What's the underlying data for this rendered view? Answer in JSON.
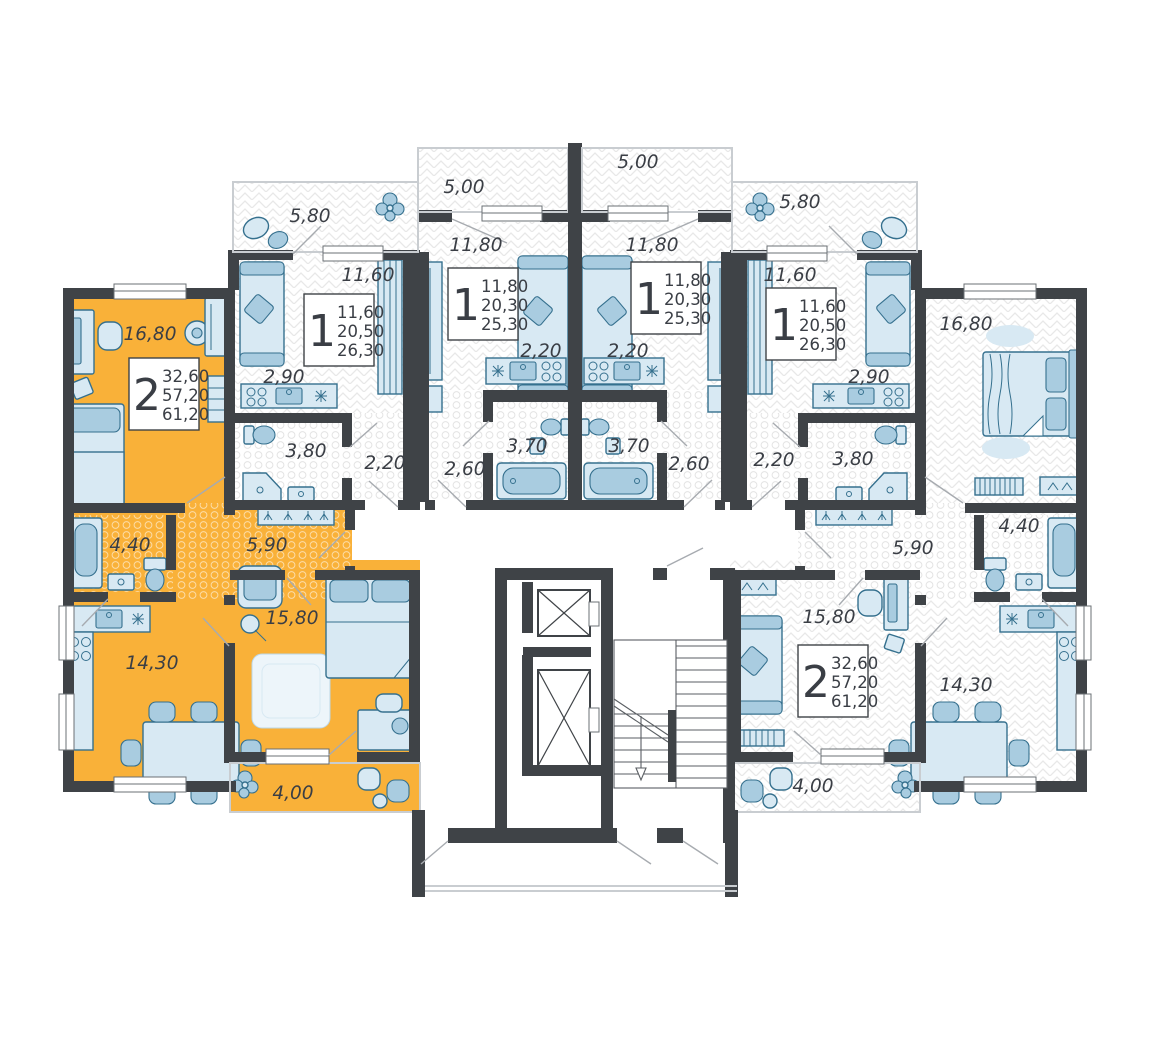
{
  "colors": {
    "wall": "#3f4347",
    "highlight_apartment": "#f9b139",
    "furniture_fill": "#d8e9f3",
    "furniture_accent": "#a9cce0",
    "furniture_stroke": "#35708e",
    "label_text": "#3a3e45"
  },
  "units": [
    {
      "name": "one-room-left",
      "rooms": "1",
      "area_living": "11,60",
      "area_main": "20,50",
      "area_total": "26,30"
    },
    {
      "name": "one-room-mid-left",
      "rooms": "1",
      "area_living": "11,80",
      "area_main": "20,30",
      "area_total": "25,30"
    },
    {
      "name": "one-room-mid-right",
      "rooms": "1",
      "area_living": "11,80",
      "area_main": "20,30",
      "area_total": "25,30"
    },
    {
      "name": "one-room-right",
      "rooms": "1",
      "area_living": "11,60",
      "area_main": "20,50",
      "area_total": "26,30"
    },
    {
      "name": "two-room-left-highlighted",
      "rooms": "2",
      "area_living": "32,60",
      "area_main": "57,20",
      "area_total": "61,20"
    },
    {
      "name": "two-room-right",
      "rooms": "2",
      "area_living": "32,60",
      "area_main": "57,20",
      "area_total": "61,20"
    }
  ],
  "room_labels": [
    "5,80",
    "5,00",
    "5,00",
    "5,80",
    "11,60",
    "11,80",
    "11,80",
    "11,60",
    "16,80",
    "16,80",
    "2,90",
    "2,90",
    "2,20",
    "2,20",
    "3,80",
    "3,80",
    "2,20",
    "2,20",
    "2,60",
    "2,60",
    "3,70",
    "3,70",
    "4,40",
    "4,40",
    "5,90",
    "5,90",
    "15,80",
    "15,80",
    "14,30",
    "14,30",
    "4,00",
    "4,00"
  ]
}
